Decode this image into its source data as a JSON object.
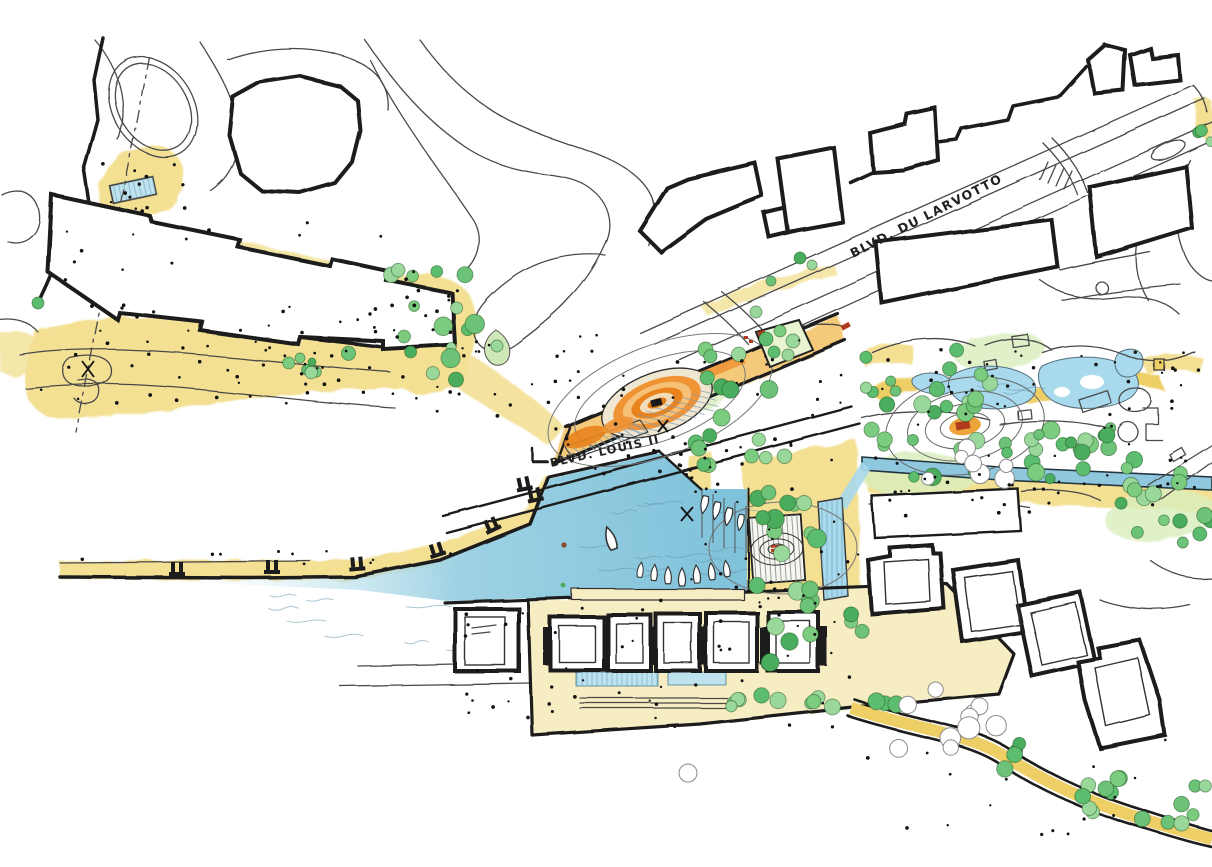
{
  "labels": {
    "boulevard_larvotto": "BLVD. DU LARVOTTO",
    "boulevard_louis_ii": "BLVD. LOUIS II"
  },
  "palette": {
    "paper": "#ffffff",
    "ink": "#1c1c1c",
    "road_line": "#4a4a4a",
    "path_yellow": "#f3e093",
    "path_yellow_deep": "#eecf66",
    "walk_orange": "#f2c061",
    "terrace_orange": "#e8831d",
    "terrace_orange_light": "#f5b75f",
    "accent_red": "#b03a1d",
    "water_blue": "#85c6dd",
    "pond_blue": "#a8d9ec",
    "steps_bluegray": "#8aa4b6",
    "tree_green": "#6cc277",
    "tree_green_dark": "#4aad5e",
    "tree_green_light": "#9ad79a",
    "grass_green": "#d8edbd"
  }
}
